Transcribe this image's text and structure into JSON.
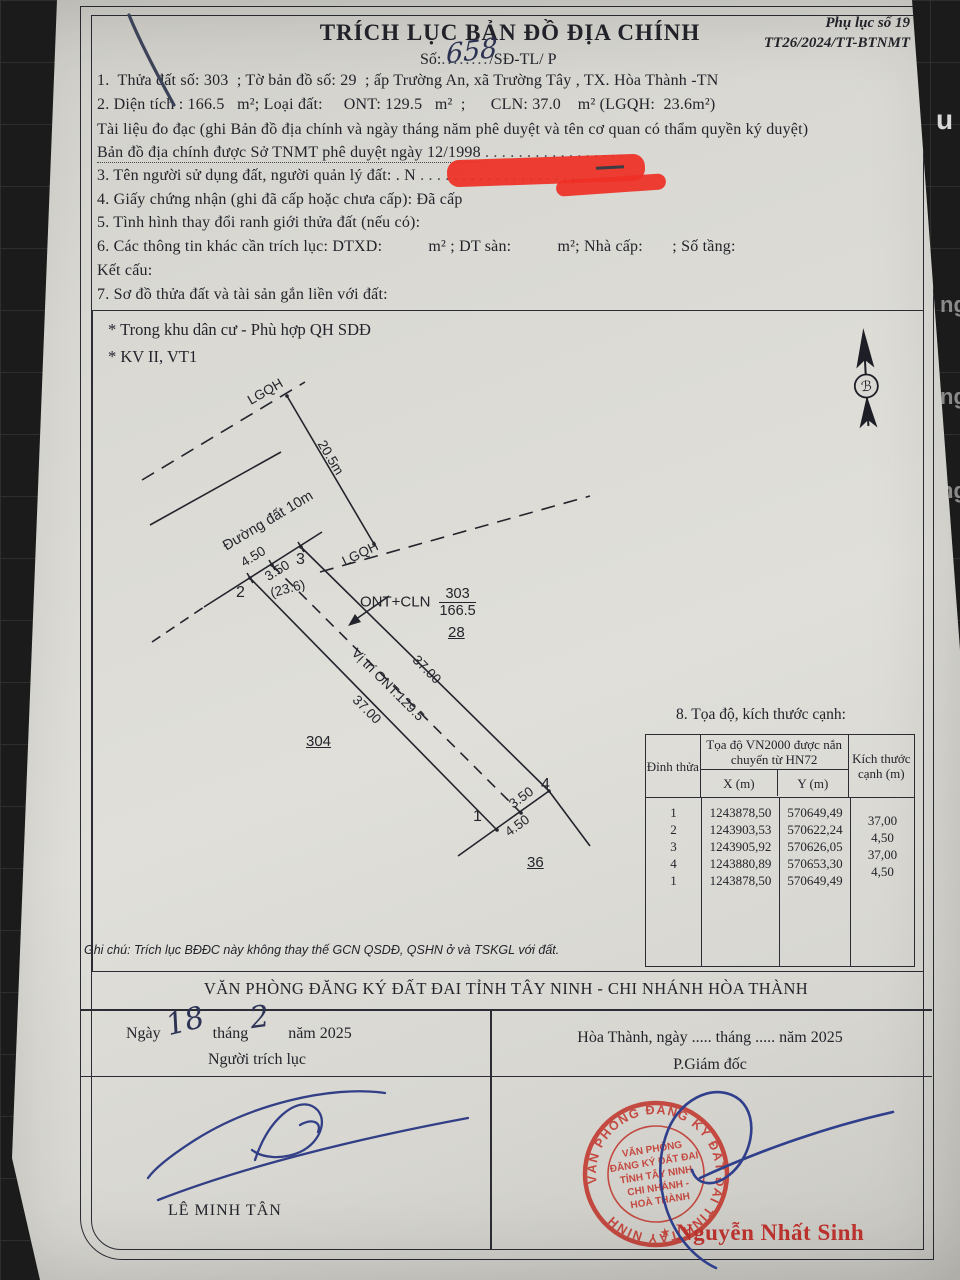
{
  "background": {
    "edge_letters": [
      "u",
      "ng",
      "ng",
      "ng"
    ]
  },
  "header": {
    "appendix1": "Phụ lục số 19",
    "appendix2": "TT26/2024/TT-BTNMT",
    "title": "TRÍCH LỤC BẢN ĐỒ ĐỊA CHÍNH",
    "so_prefix": "Số:",
    "so_value": "658",
    "so_dots": "........",
    "so_suffix": "/SĐ-TL/ P"
  },
  "items": {
    "i1": "1.  Thửa đất số: 303  ; Tờ bản đồ số: 29  ; ấp Trường An, xã Trường Tây , TX. Hòa Thành -TN",
    "i2": "2. Diện tích : 166.5   m²; Loại đất:     ONT: 129.5   m²  ;      CLN: 37.0    m² (LGQH:  23.6m²)",
    "i2_note": "Tài liệu đo đạc (ghi Bản đồ địa chính và ngày tháng năm phê duyệt và tên cơ quan có thẩm quyền ký duyệt)",
    "i2_note2": "Bản đồ địa chính được Sở TNMT phê duyệt ngày 12/1998",
    "i2_note2_dots": " . . . . . . . . . . . . . . . . .",
    "i3_pre": "3. Tên người sử dụng đất, người quản lý đất: . N",
    "i3_dots": ". . . . . . . . . . . . . . . . . . . . . . . . .",
    "i4": "4. Giấy chứng nhận (ghi đã cấp hoặc chưa cấp): Đã cấp",
    "i5": "5. Tình hình thay đổi ranh giới thửa đất (nếu có):",
    "i6": "6. Các thông tin khác cần trích lục: DTXD:           m² ; DT sàn:           m²; Nhà cấp:       ; Số tầng:",
    "i6b": "Kết cấu:",
    "i7": "7. Sơ đồ thửa đất và tài sản gắn liền với đất:"
  },
  "map": {
    "note1": "* Trong khu dân cư - Phù hợp QH SDĐ",
    "note2": "* KV II, VT1",
    "lgqh_top": "LGQH",
    "lgqh_mid": "LGQH",
    "dim_205": "20.5m",
    "road": "Đường đất 10m",
    "v1": "1",
    "v2": "2",
    "v3": "3",
    "v4": "4",
    "d450_top": "4.50",
    "d350_top": "3.50",
    "area_lgqh": "(23.6)",
    "ont_cln": "ONT+CLN",
    "parcel_no": "303",
    "parcel_area": "166.5",
    "adj28": "28",
    "adj304": "304",
    "adj36": "36",
    "d37_right": "37.00",
    "d37_left": "37.00",
    "vitri": "Vị trí ONT:129.5",
    "d350_bot": "3.50",
    "d450_bot": "4.50",
    "north_letter": "ℬ"
  },
  "section8": {
    "title": "8. Tọa độ, kích thước cạnh:",
    "col_vertex": "Đỉnh thửa",
    "col_coord": "Tọa độ VN2000 được nắn chuyển từ HN72",
    "col_x": "X (m)",
    "col_y": "Y (m)",
    "col_size": "Kích thước cạnh (m)",
    "rows": [
      {
        "v": "1",
        "x": "1243878,50",
        "y": "570649,49"
      },
      {
        "v": "2",
        "x": "1243903,53",
        "y": "570622,24"
      },
      {
        "v": "3",
        "x": "1243905,92",
        "y": "570626,05"
      },
      {
        "v": "4",
        "x": "1243880,89",
        "y": "570653,30"
      },
      {
        "v": "1",
        "x": "1243878,50",
        "y": "570649,49"
      }
    ],
    "edge_sizes": [
      "37,00",
      "4,50",
      "37,00",
      "4,50"
    ]
  },
  "note": "Ghi chú: Trích lục BĐĐC này không thay thế GCN QSDĐ, QSHN ở và TSKGL với đất.",
  "footer": {
    "office": "VĂN PHÒNG ĐĂNG KÝ ĐẤT ĐAI TỈNH TÂY NINH - CHI NHÁNH HÒA THÀNH",
    "d1": "Ngày",
    "d2": "tháng",
    "d3": "năm  2025",
    "hand_day": "18",
    "hand_month": "2",
    "left_role": "Người trích lục",
    "right_date": "Hòa Thành, ngày ..... tháng ..... năm  2025",
    "right_role": "P.Giám đốc",
    "left_name": "LÊ MINH TÂN",
    "right_name": "Nguyễn Nhất Sinh"
  },
  "stamp": {
    "ring_text": "VĂN PHÒNG ĐĂNG KÝ ĐẤT ĐAI TỈNH TÂY NINH",
    "star": "★",
    "lines": [
      "VĂN PHÒNG",
      "ĐĂNG KÝ ĐẤT ĐAI",
      "TỈNH TÂY NINH",
      "CHI NHÁNH -",
      "HOÀ THÀNH"
    ]
  },
  "colors": {
    "paper": "#d9d8d2",
    "marker_red": "#ee2f26",
    "stamp_red": "#c23b32",
    "ink_blue": "#2f3f8c"
  }
}
